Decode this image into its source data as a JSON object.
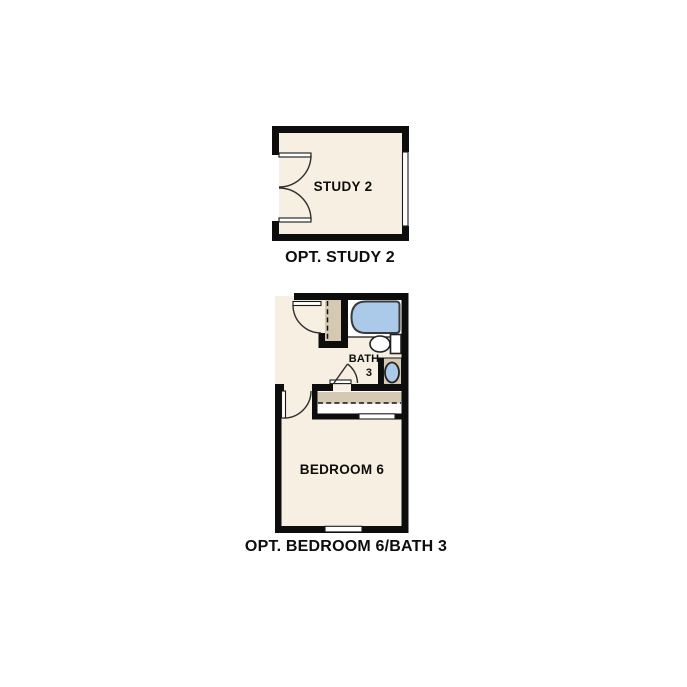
{
  "canvas": {
    "width": 687,
    "height": 687,
    "background": "#ffffff"
  },
  "plans": {
    "study": {
      "room_label": "STUDY 2",
      "caption": "OPT. STUDY 2",
      "features": [
        "double-french-door",
        "window"
      ]
    },
    "bedroom_bath": {
      "bath_label_line1": "BATH",
      "bath_label_line2": "3",
      "bedroom_label": "BEDROOM 6",
      "caption": "OPT. BEDROOM 6/BATH 3",
      "fixtures": [
        "bathtub",
        "toilet",
        "sink-vanity",
        "linen-closet",
        "bedroom-closet",
        "window"
      ]
    }
  },
  "colors": {
    "wall": "#0d0d0d",
    "room_fill": "#f6efe2",
    "cabinet_tan": "#d5c9b3",
    "fixture_blue": "#abc9e8",
    "fixture_white": "#ffffff",
    "line": "#2e2e2e"
  }
}
